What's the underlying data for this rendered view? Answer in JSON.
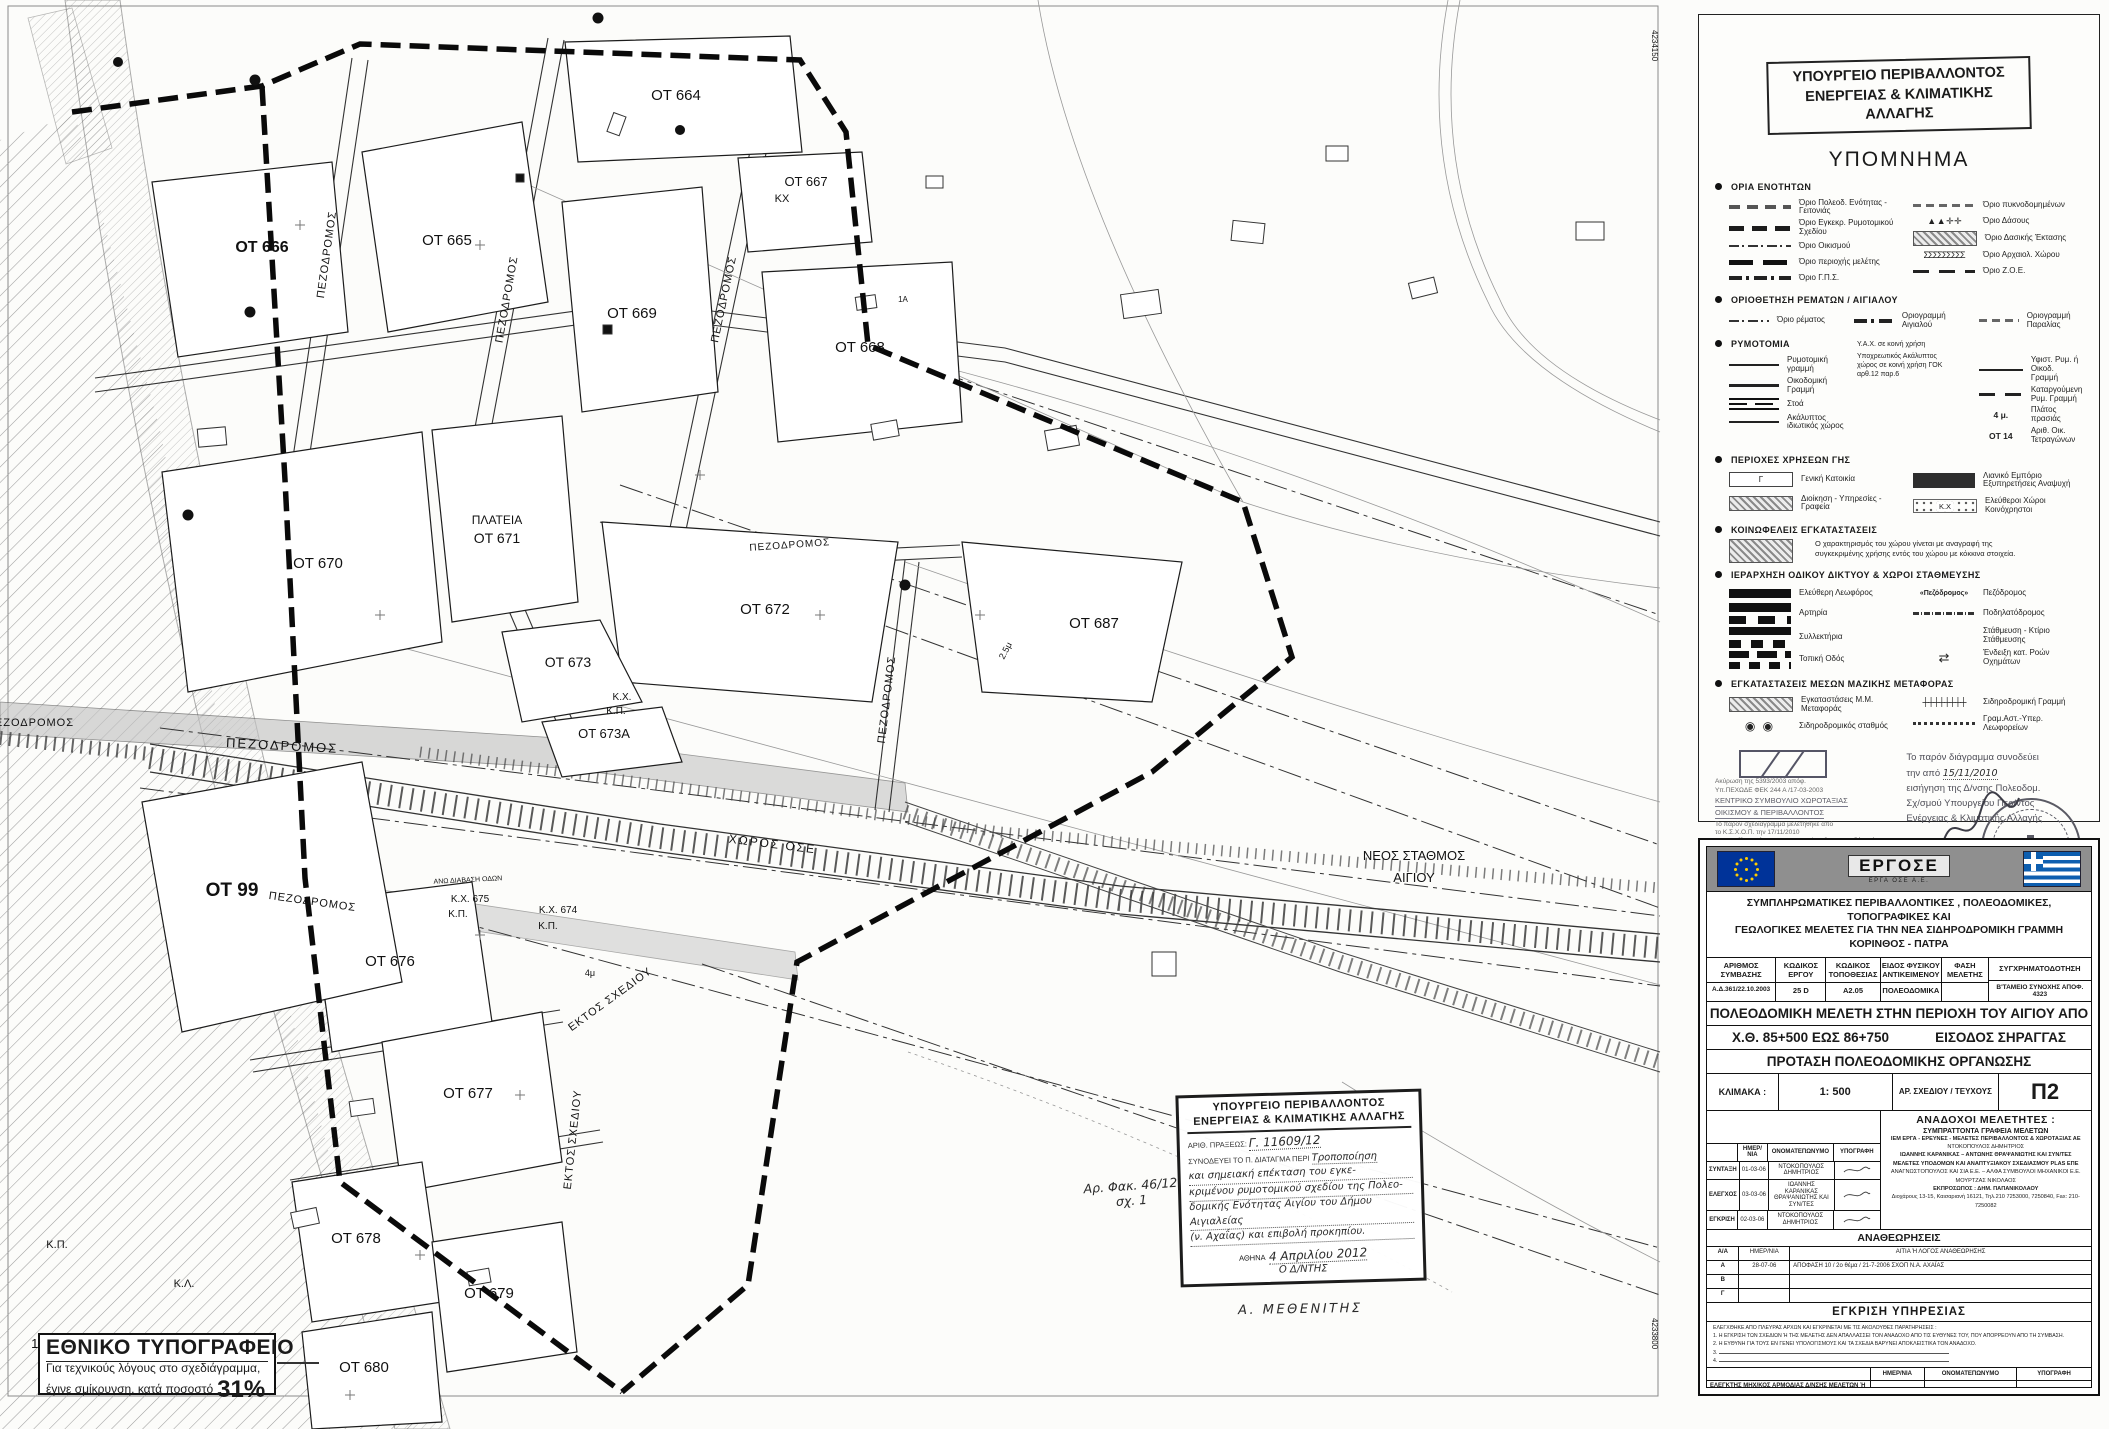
{
  "map": {
    "frame_coord_top": "4234150",
    "frame_coord_bottom": "4233800",
    "labels": [
      "ΟΤ 664",
      "ΟΤ 667",
      "ΚΧ",
      "ΟΤ 666",
      "ΟΤ 665",
      "ΟΤ 669",
      "ΟΤ 668",
      "ΠΛΑΤΕΙΑ",
      "ΟΤ 671",
      "ΟΤ 670",
      "ΟΤ 672",
      "ΟΤ 687",
      "ΟΤ 673",
      "Κ.Χ.",
      "Κ.Π.",
      "ΟΤ 673Α",
      "ΠΕΖΟΔΡΟΜΟΣ",
      "ΟΤ 99",
      "ΧΩΡΟΣ ΟΣΕ",
      "ΝΕΟΣ ΣΤΑΘΜΟΣ",
      "ΑΙΓΙΟΥ",
      "ΠΕΖΟΔΡΟΜΟΣ",
      "Κ.Χ. 675",
      "Κ.Π.",
      "Κ.Χ. 674",
      "Κ.Π.",
      "ΟΤ 676",
      "ΕΚΤΟΣ ΣΧΕΔΙΟΥ",
      "ΕΚΤΟΣ ΣΧΕΔΙΟΥ",
      "ΟΤ 677",
      "ΟΤ 678",
      "ΟΤ 679",
      "ΟΤ 680",
      "Κ.Π.",
      "Κ.Λ.",
      "105",
      "ΠΕΖΟΔΡΟΜΟΣ",
      "ΠΕΖΟΔΡΟΜΟΣ",
      "ΠΕΖΟΔΡΟΜΟΣ",
      "ΠΕΖΟΔΡΟΜΟΣ",
      "ΠΕΖΟΔΡΟΜΟΣ",
      "ΠΕΖΟΔΡΟΜΟΣ",
      "ΑΝΩ ΔΙΑΒΑΣΗ ΟΔΩΝ",
      "2.5μ",
      "4μ",
      "1Α"
    ]
  },
  "handnote": {
    "ministry1": "ΥΠΟΥΡΓΕΙΟ ΠΕΡΙΒΑΛΛΟΝΤΟΣ",
    "ministry2": "ΕΝΕΡΓΕΙΑΣ & ΚΛΙΜΑΤΙΚΗΣ ΑΛΛΑΓΗΣ",
    "protocol_label": "ΑΡΙΘ. ΠΡΑΞΕΩΣ:",
    "protocol_value": "Γ. 11609/12",
    "accompanies_label": "ΣΥΝΟΔΕΥΕΙ ΤΟ Π. ΔΙΑΤΑΓΜΑ ΠΕΡΙ",
    "subject1": "Τροποποίηση",
    "subject2": "και σημειακή επέκταση του εγκε-",
    "subject3": "κριμένου ρυμοτομικού σχεδίου της Πολεο-",
    "subject4": "δομικής Ενότητας Αιγίου του Δήμου Αιγιαλείας",
    "subject5": "(ν. Αχαΐας) και επιβολή προκηπίου.",
    "date_prefix": "ΑΘΗΝΑ",
    "date_value": "4 Απριλίου 2012",
    "director_line": "Ο Δ/ΝΤΗΣ",
    "signature_name": "Α. ΜΕΘΕΝΙΤΗΣ",
    "file_ref1": "Αρ. Φακ. 46/12",
    "file_ref2": "σχ. 1"
  },
  "legend": {
    "ministry_line1": "ΥΠΟΥΡΓΕΙΟ ΠΕΡΙΒΑΛΛΟΝΤΟΣ",
    "ministry_line2": "ΕΝΕΡΓΕΙΑΣ & ΚΛΙΜΑΤΙΚΗΣ ΑΛΛΑΓΗΣ",
    "title": "ΥΠΟΜΝΗΜΑ",
    "sec1_title": "ΟΡΙΑ ΕΝΟΤΗΤΩΝ",
    "sec1_left": [
      "Όριο Πολεοδ. Ενότητας - Γειτονιάς",
      "Όριο Εγκεκρ. Ρυμοτομικού Σχεδίου",
      "Όριο Οικισμού",
      "Όριο περιοχής μελέτης",
      "Όριο Γ.Π.Σ."
    ],
    "sec1_right": [
      "Όριο πυκνοδομημένων",
      "Όριο Δάσους",
      "Όριο Δασικής Έκτασης",
      "Όριο Αρχαιολ. Χώρου",
      "Όριο Ζ.Ο.Ε."
    ],
    "sec2_title": "ΟΡΙΟΘΕΤΗΣΗ ΡΕΜΑΤΩΝ / ΑΙΓΙΑΛΟΥ",
    "sec2_items": [
      "Όριο ρέματος",
      "Οριογραμμή Αιγιαλού",
      "Οριογραμμή Παραλίας"
    ],
    "sec3_title": "ΡΥΜΟΤΟΜΙΑ",
    "sec3_left": [
      "Ρυμοτομική γραμμή",
      "Οικοδομική Γραμμή",
      "Στοά",
      "Ακάλυπτος ιδιωτικός χώρος"
    ],
    "sec3_mid1": "Υ.Α.Χ. σε κοινή χρήση",
    "sec3_mid2": "Υποχρεωτικός Ακάλυπτος χώρος σε κοινή χρήση ΓΟΚ αρθ.12 παρ.6",
    "sec3_right": [
      "Υφιστ. Ρυμ. ή Οικοδ. Γραμμή",
      "Καταργούμενη Ρυμ. Γραμμή",
      "Πλάτος πρασιάς",
      "Αριθ. Οικ. Τετραγώνων"
    ],
    "sec3_sym_width": "4 μ.",
    "sec3_sym_ot": "ΟΤ 14",
    "sec4_title": "ΠΕΡΙΟΧΕΣ ΧΡΗΣΕΩΝ ΓΗΣ",
    "sec4_items": [
      "Γενική Κατοικία",
      "Λιανικό Εμπόριο Εξυπηρετήσεις Αναψυχή",
      "Διοίκηση - Υπηρεσίες - Γραφεία",
      "Ελεύθεροι Χώροι Κοινόχρηστοι"
    ],
    "sec4_sym_g": "Γ",
    "sec4_sym_kx": "Κ.Χ",
    "sec5_title": "ΚΟΙΝΩΦΕΛΕΙΣ ΕΓΚΑΤΑΣΤΑΣΕΙΣ",
    "sec5_note": "Ο χαρακτηρισμός του χώρου γίνεται με αναγραφή της συγκεκριμένης χρήσης εντός του χώρου με κόκκινα στοιχεία.",
    "sec6_title": "ΙΕΡΑΡΧΗΣΗ ΟΔΙΚΟΥ ΔΙΚΤΥΟΥ & ΧΩΡΟΙ ΣΤΑΘΜΕΥΣΗΣ",
    "sec6_left": [
      "Ελεύθερη Λεωφόρος",
      "Αρτηρία",
      "Συλλεκτήρια",
      "Τοπική Οδός"
    ],
    "sec6_right": [
      "Πεζόδρομος",
      "Ποδηλατόδρομος",
      "Στάθμευση - Κτίριο Στάθμευσης",
      "Ένδειξη κατ. Ροών Οχημάτων"
    ],
    "sec6_sym_pez": "«Πεζόδρομος»",
    "sec7_title": "ΕΓΚΑΤΑΣΤΑΣΕΙΣ ΜΕΣΩΝ ΜΑΖΙΚΗΣ ΜΕΤΑΦΟΡΑΣ",
    "sec7_left": [
      "Εγκαταστάσεις Μ.Μ. Μεταφοράς",
      "Σιδηροδρομικός σταθμός"
    ],
    "sec7_right": [
      "Σιδηροδρομική Γραμμή",
      "Γραμ.Αστ.-Υπερ. Λεωφορείων"
    ],
    "icons": {
      "forest": "▲ ▲ ✛ ✛",
      "archeo": "ΣΣΣΣΣΣΣΣΣ",
      "rail": "┼┼┼┼┼┼┼┼",
      "station": "◉ ◉",
      "flow_arrows": "⇄"
    },
    "stamp_left": {
      "l1": "Ακύρωση της 5393/2003 απόφ.",
      "l2": "Υπ.ΠΕΧΩΔΕ ΦΕΚ 244 Α /17-03-2003",
      "l3": "ΚΕΝΤΡΙΚΟ ΣΥΜΒΟΥΛΙΟ ΧΩΡΟΤΑΞΙΑΣ",
      "l4": "ΟΙΚΙΣΜΟΥ & ΠΕΡΙΒΑΛΛΟΝΤΟΣ",
      "l5": "Το παρόν σχεδιάγραμμα μελετήθηκε από",
      "l6": "το Κ.Σ.Χ.Ο.Π. την 17/11/2010",
      "l7": "και εγκρίθηκε σύμφωνα με την υπ' αριθμ.",
      "l8": "γνωμοδότησή του.",
      "president": "ΠΡΟΕΔΡΟΣ",
      "secretary": "ΓΡΑΜΜΑΤΕΑΣ",
      "name1": "Β. ΑΓΓΕΛΙΔΟΥ",
      "name2": "Κ. ΚΑΖΑΝΗ"
    },
    "stamp_right": {
      "l1": "Το παρόν διάγραμμα συνοδεύει",
      "l2a": "την από",
      "l2b": "15/11/2010",
      "l3": "εισήγηση της Δ/νσης Πολεοδομ.",
      "l4": "Σχ/σμού Υπουργείου Περ/ντος",
      "l5": "Ενέργειας & Κλιματικής Αλλαγής"
    }
  },
  "titleblock": {
    "ergose": "ΕΡΓΟΣΕ",
    "ergose_sub": "ΕΡΓΑ ΟΣΕ Α.Ε.",
    "project1": "ΣΥΜΠΛΗΡΩΜΑΤΙΚΕΣ ΠΕΡΙΒΑΛΛΟΝΤΙΚΕΣ , ΠΟΛΕΟΔΟΜΙΚΕΣ, ΤΟΠΟΓΡΑΦΙΚΕΣ ΚΑΙ",
    "project2": "ΓΕΩΛΟΓΙΚΕΣ ΜΕΛΕΤΕΣ ΓΙΑ ΤΗΝ ΝΕΑ ΣΙΔΗΡΟΔΡΟΜΙΚΗ ΓΡΑΜΜΗ ΚΟΡΙΝΘΟΣ - ΠΑΤΡΑ",
    "cols": [
      "ΑΡΙΘΜΟΣ ΣΥΜΒΑΣΗΣ",
      "ΚΩΔΙΚΟΣ ΕΡΓΟΥ",
      "ΚΩΔΙΚΟΣ ΤΟΠΟΘΕΣΙΑΣ",
      "ΕΙΔΟΣ ΦΥΣΙΚΟΥ ΑΝΤΙΚΕΙΜΕΝΟΥ",
      "ΦΑΣΗ ΜΕΛΕΤΗΣ",
      "ΣΥΓΧΡΗΜΑΤΟΔΟΤΗΣΗ"
    ],
    "vals": [
      "Α.Δ.361/22.10.2003",
      "25 D",
      "Α2.05",
      "ΠΟΛΕΟΔΟΜΙΚΑ",
      "",
      "Β'ΤΑΜΕΙΟ ΣΥΝΟΧΗΣ ΑΠΟΦ. 4323"
    ],
    "subject1": "ΠΟΛΕΟΔΟΜΙΚΗ ΜΕΛΕΤΗ ΣΤΗΝ ΠΕΡΙΟΧΗ ΤΟΥ ΑΙΓΙΟΥ ΑΠΟ",
    "subject2a": "Χ.Θ. 85+500 ΕΩΣ 86+750",
    "subject2b": "ΕΙΣΟΔΟΣ ΣΗΡΑΓΓΑΣ",
    "subject3": "ΠΡΟΤΑΣΗ ΠΟΛΕΟΔΟΜΙΚΗΣ ΟΡΓΑΝΩΣΗΣ",
    "scale_label": "ΚΛΙΜΑΚΑ :",
    "scale_value": "1: 500",
    "sheet_label": "ΑΡ. ΣΧΕΔΙΟΥ / ΤΕΥΧΟΥΣ",
    "sheet_value": "Π2",
    "designers_title": "ΑΝΑΔΟΧΟΙ ΜΕΛΕΤΗΤΕΣ :",
    "designers_sub": "ΣΥΜΠΡΑΤΤΟΝΤΑ ΓΡΑΦΕΙΑ ΜΕΛΕΤΩΝ",
    "designers": [
      "ΙΕΜ ΕΡΓΑ - ΕΡΕΥΝΕΣ - ΜΕΛΕΤΕΣ ΠΕΡΙΒΑΛΛΟΝΤΟΣ & ΧΩΡΟΤΑΞΙΑΣ ΑΕ",
      "ΝΤΟΚΟΠΟΥΛΟΣ ΔΗΜΗΤΡΙΟΣ",
      "ΙΩΑΝΝΗΣ ΚΑΡΑΝΙΚΑΣ – ΑΝΤΩΝΗΣ ΘΡΑΨΑΝΙΩΤΗΣ ΚΑΙ ΣΥΝ/ΤΕΣ",
      "ΜΕΛΕΤΕΣ ΥΠΟΔΟΜΩΝ ΚΑΙ ΑΝΑΠΤΥΞΙΑΚΟΥ ΣΧΕΔΙΑΣΜΟΥ PLAS ΕΠΕ",
      "ΑΝΑΓΝΩΣΤΟΠΟΥΛΟΣ ΚΑΙ ΣΙΑ Ε.Ε. – ΑΛΦΑ ΣΥΜΒΟΥΛΟΙ ΜΗΧΑΝΙΚΟΙ Ε.Ε.",
      "ΜΟΥΡΤΖΑΣ ΝΙΚΟΛΑΟΣ",
      "ΕΚΠΡΟΣΩΠΟΣ : ΔΗΜ. ΠΑΠΑΝΙΚΟΛΑΟΥ",
      "Διοχάρους 13-15, Καισαριανή 16121, Τηλ.210 7253000, 7250840, Fax: 210-7250082"
    ],
    "sig_cols": [
      "ΗΜΕΡ/ΝΙΑ",
      "ΟΝΟΜΑΤΕΠΩΝΥΜΟ",
      "ΥΠΟΓΡΑΦΗ"
    ],
    "sig_rows": [
      {
        "stage": "ΣΥΝΤΑΞΗ",
        "date": "01-03-06",
        "name": "ΝΤΟΚΟΠΟΥΛΟΣ ΔΗΜΗΤΡΙΟΣ"
      },
      {
        "stage": "ΕΛΕΓΧΟΣ",
        "date": "03-03-06",
        "name": "ΙΩΑΝΝΗΣ ΚΑΡΑΝΙΚΑΣ ΘΡΑΨΑΝΙΩΤΗΣ ΚΑΙ ΣΥΝ/ΤΕΣ"
      },
      {
        "stage": "ΕΓΚΡΙΣΗ",
        "date": "02-03-06",
        "name": "ΝΤΟΚΟΠΟΥΛΟΣ ΔΗΜΗΤΡΙΟΣ"
      }
    ],
    "rev_title": "ΑΝΑΘΕΩΡΗΣΕΙΣ",
    "rev_cols": [
      "Α/Α",
      "ΗΜΕΡ/ΝΙΑ",
      "ΑΙΤΙΑ Ή ΛΟΓΟΣ ΑΝΑΘΕΩΡΗΣΗΣ"
    ],
    "rev_rows": [
      {
        "aa": "Α",
        "date": "28-07-06",
        "reason": "ΑΠΟΦΑΣΗ 10 / 2ο θέμα / 21-7-2006 ΣΧΟΠ Ν.Α. ΑΧΑΪΑΣ"
      },
      {
        "aa": "Β",
        "date": "",
        "reason": ""
      },
      {
        "aa": "Γ",
        "date": "",
        "reason": ""
      }
    ],
    "approval_title": "ΕΓΚΡΙΣΗ ΥΠΗΡΕΣΙΑΣ",
    "approval_intro": "ΕΛΕΓΧΘΗΚΕ ΑΠΟ ΠΛΕΥΡΑΣ ΑΡΧΩΝ ΚΑΙ ΕΓΚΡΙΝΕΤΑΙ ΜΕ ΤΙΣ ΑΚΟΛΟΥΘΕΣ ΠΑΡΑΤΗΡΗΣΕΙΣ :",
    "approval_note1": "1.  Η ΕΓΚΡΙΣΗ ΤΩΝ ΣΧΕΔΙΩΝ Ή ΤΗΣ ΜΕΛΕΤΗΣ ΔΕΝ ΑΠΑΛΛΑΣΣΕΙ ΤΟΝ ΑΝΑΔΟΧΟ ΑΠΟ ΤΙΣ ΕΥΘΥΝΕΣ ΤΟΥ, ΠΟΥ ΑΠΟΡΡΕΟΥΝ ΑΠΟ ΤΗ ΣΥΜΒΑΣΗ.",
    "approval_note2": "2.  Η ΕΥΘΥΝΗ ΓΙΑ ΤΟΥΣ ΕΝ ΓΕΝΕΙ ΥΠΟΛΟΓΙΣΜΟΥΣ ΚΑΙ ΤΑ ΣΧΕΔΙΑ ΒΑΡΥΝΕΙ ΑΠΟΚΛΕΙΣΤΙΚΑ ΤΟΝ ΑΝΑΔΟΧΟ.",
    "approval_note3": "3.",
    "approval_note4": "4.",
    "approval_cols": [
      "ΗΜΕΡ/ΝΙΑ",
      "ΟΝΟΜΑΤΕΠΩΝΥΜΟ",
      "ΥΠΟΓΡΑΦΗ"
    ],
    "approval_rows": [
      {
        "role": "ΕΛΕΓΚΤΗΣ ΜΗΧ/ΚΟΣ ΑΡΜΟΔΙΑΣ Δ/ΝΣΗΣ ΜΕΛΕΤΩΝ Ή ΕΞΩΤΕΡΙΚΟΣ",
        "name": ""
      },
      {
        "role": "ΕΛΕΓΚΤΕΣ ΜΗΧ/ΚΟΙ ΣΥΝΑΡΜΟΔ. Δ/ΝΣΕΩΝ ΜΕΛΕΤΩΝ Ή ΕΞΩΤΕΡΙΚΟΙ",
        "name": ""
      },
      {
        "role": "ΕΠΙΒΛΕΠΩΝ / ΕΠΙΒΛΕΠΟΥΣΑ ΜΕΛΕΤΗΣ",
        "name": "Μ. ΜΑΡΑΒΕΓΙΑ"
      },
      {
        "role": "Δ/ΝΤΗΣ ΑΡΜΟΔΙΑΣ Δ/ΝΣΗΣ ΜΕΛΕΤΩΝ",
        "name": "Β. ΣΠΥΡΑΚΟΣ"
      },
      {
        "role": "Δ/ΝΤΕΣ ΣΥΝΑΡΜΟΔΙΩΝ Δ/ΝΣΕΩΝ ΜΕΛΕΤΩΝ",
        "name": ""
      },
      {
        "role": "Ο ΑΝΑΠΛΗΡΩΝ ΤΟΝ Δ/ΝΤΗ ΜΕΛΕΤΩΝ ΝΕΩΝ ΕΡΓΩΝ",
        "name": "Γ. ΠΙΛΑΤΗΣ"
      }
    ],
    "dims_label": "ΔΙΑΣΤΑΣΕΙΣ ΣΧΕΔΙΟΥ :",
    "dims_value": "______ x ______",
    "ergose_no_label": "ΑΡ. ΣΧ. ΕΡΓΟΣΕ :",
    "ergose_no_value": "______ / ______"
  },
  "printer": {
    "title": "ΕΘΝΙΚΟ ΤΥΠΟΓΡΑΦΕΙΟ",
    "line1": "Για τεχνικούς λόγους στο σχεδιάγραμμα,",
    "line2": "έγινε σμίκρυνση, κατά ποσοστό",
    "percent": "31%"
  }
}
